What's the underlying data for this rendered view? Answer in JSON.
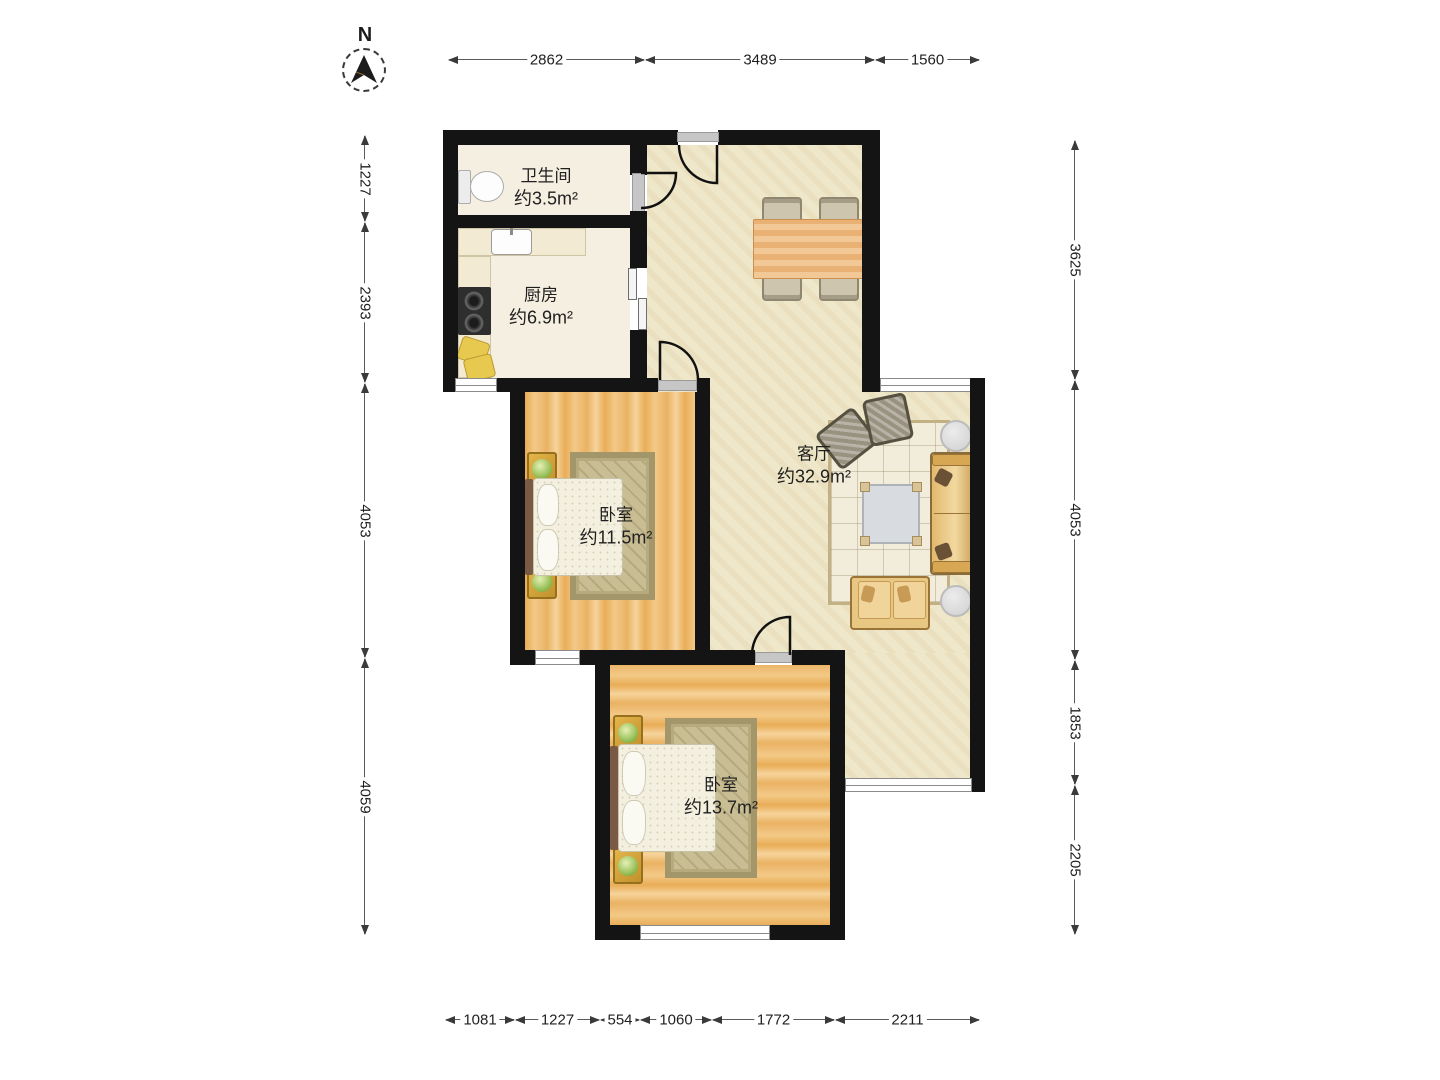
{
  "compass": {
    "label": "N"
  },
  "dims": {
    "top": [
      "2862",
      "3489",
      "1560"
    ],
    "left": [
      "1227",
      "2393",
      "4053",
      "4059"
    ],
    "right": [
      "3625",
      "4053",
      "1853",
      "2205"
    ],
    "bottom": [
      "1081",
      "1227",
      "554",
      "1060",
      "1772",
      "2211"
    ]
  },
  "rooms": {
    "bathroom": {
      "name": "卫生间",
      "area": "约3.5m²"
    },
    "kitchen": {
      "name": "厨房",
      "area": "约6.9m²"
    },
    "bedroom1": {
      "name": "卧室",
      "area": "约11.5m²"
    },
    "living": {
      "name": "客厅",
      "area": "约32.9m²"
    },
    "bedroom2": {
      "name": "卧室",
      "area": "约13.7m²"
    }
  },
  "colors": {
    "wall": "#141414",
    "floor_living": "#efe7c9",
    "floor_tile": "#f5efe1",
    "wood": "#eeb868",
    "window_frame": "#8b8b8b",
    "dimension_text": "#1f1f1f"
  }
}
